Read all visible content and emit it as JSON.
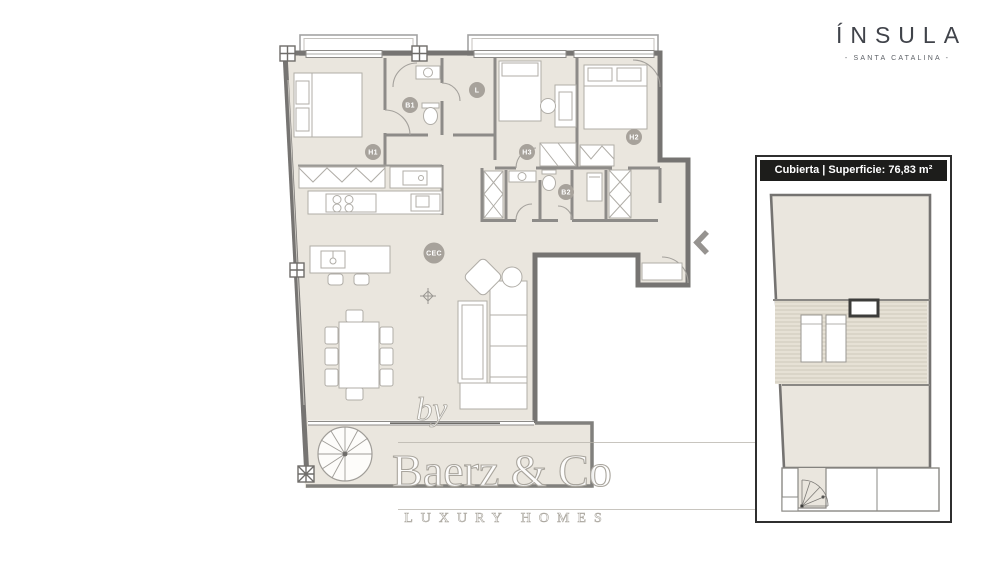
{
  "brand": {
    "name": "ÍNSULA",
    "tagline": "- SANTA CATALINA -"
  },
  "roof_panel": {
    "title": "Cubierta | Superficie: 76,83 m²"
  },
  "watermark": {
    "by": "by",
    "name": "Baerz & Co",
    "subtitle": "LUXURY HOMES"
  },
  "floor_plan": {
    "room_labels": [
      {
        "id": "H1",
        "label": "H1"
      },
      {
        "id": "B1",
        "label": "B1"
      },
      {
        "id": "L",
        "label": "L"
      },
      {
        "id": "H3",
        "label": "H3"
      },
      {
        "id": "H2",
        "label": "H2"
      },
      {
        "id": "B2",
        "label": "B2"
      },
      {
        "id": "CEC",
        "label": "CEC"
      }
    ],
    "icons": [
      "entry-arrow",
      "spiral-stair",
      "ceiling-light"
    ]
  },
  "colors": {
    "floor": "#eae6de",
    "wall": "#767472",
    "label_circle": "#a7a29b",
    "panel_header_bg": "#1d1d1b",
    "brand_text": "#40434a",
    "watermark": "#a9a59d"
  }
}
